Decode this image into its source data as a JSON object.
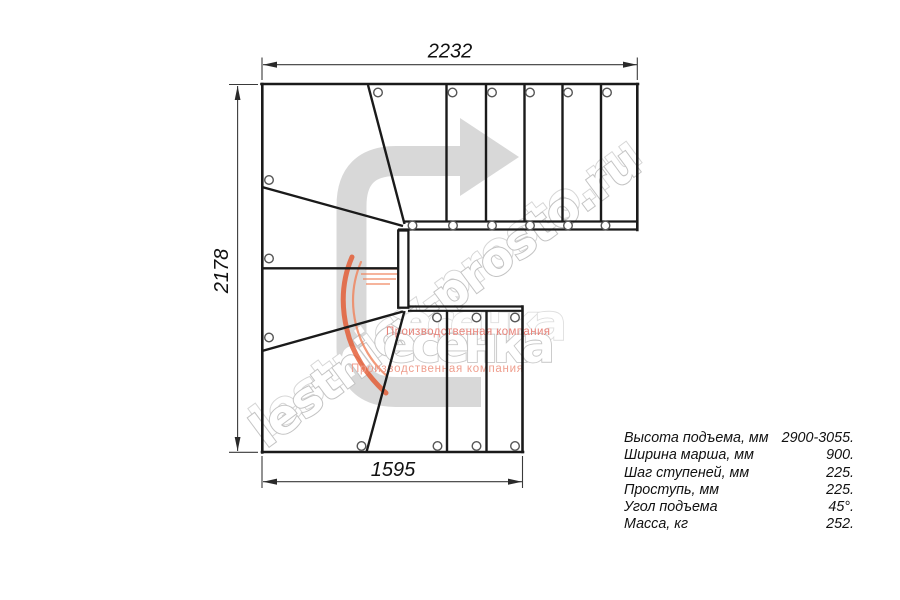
{
  "drawing": {
    "dimensions": {
      "top": "2232",
      "left": "2178",
      "bottom": "1595"
    },
    "watermark": {
      "site": "lestnicy-prosto.ru",
      "brand": "есенка",
      "tagline": "Производственная компания"
    },
    "specs": {
      "rows": [
        {
          "label": "Высота подъема, мм",
          "value": "2900-3055."
        },
        {
          "label": "Ширина марша, мм",
          "value": "900."
        },
        {
          "label": "Шаг ступеней, мм",
          "value": "225."
        },
        {
          "label": "Проступь, мм",
          "value": "225."
        },
        {
          "label": "Угол подъема",
          "value": "45°."
        },
        {
          "label": "Масса, кг",
          "value": "252."
        }
      ]
    },
    "colors": {
      "line": "#1a1a1a",
      "dim_line": "#3a3a3a",
      "arrow_gray": "#d8d8d8",
      "watermark_outline": "#c3c3c3",
      "logo_orange": "#e4572e",
      "tagline_red": "#e8837a"
    }
  }
}
